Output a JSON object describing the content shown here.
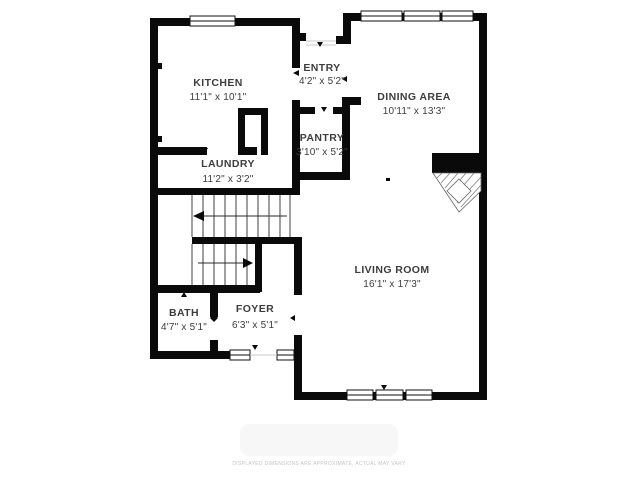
{
  "rooms": {
    "kitchen": {
      "name": "KITCHEN",
      "dims": "11'1\" x 10'1\""
    },
    "entry": {
      "name": "ENTRY",
      "dims": "4'2\" x 5'2\""
    },
    "dining_area": {
      "name": "DINING AREA",
      "dims": "10'11\" x 13'3\""
    },
    "pantry": {
      "name": "PANTRY",
      "dims": "3'10\" x 5'2\""
    },
    "laundry": {
      "name": "LAUNDRY",
      "dims": "11'2\" x 3'2\""
    },
    "living_room": {
      "name": "LIVING ROOM",
      "dims": "16'1\" x 17'3\""
    },
    "bath": {
      "name": "BATH",
      "dims": "4'7\" x 5'1\""
    },
    "foyer": {
      "name": "FOYER",
      "dims": "6'3\" x 5'1\""
    }
  },
  "disclaimer": "DISPLAYED DIMENSIONS ARE APPROXIMATE, ACTUAL MAY VARY",
  "colors": {
    "wall": "#0a0a0a",
    "background": "#ffffff",
    "label": "#3d3d3d",
    "stair_line": "#2b2b2b",
    "disclaimer": "#c4c4c4"
  }
}
